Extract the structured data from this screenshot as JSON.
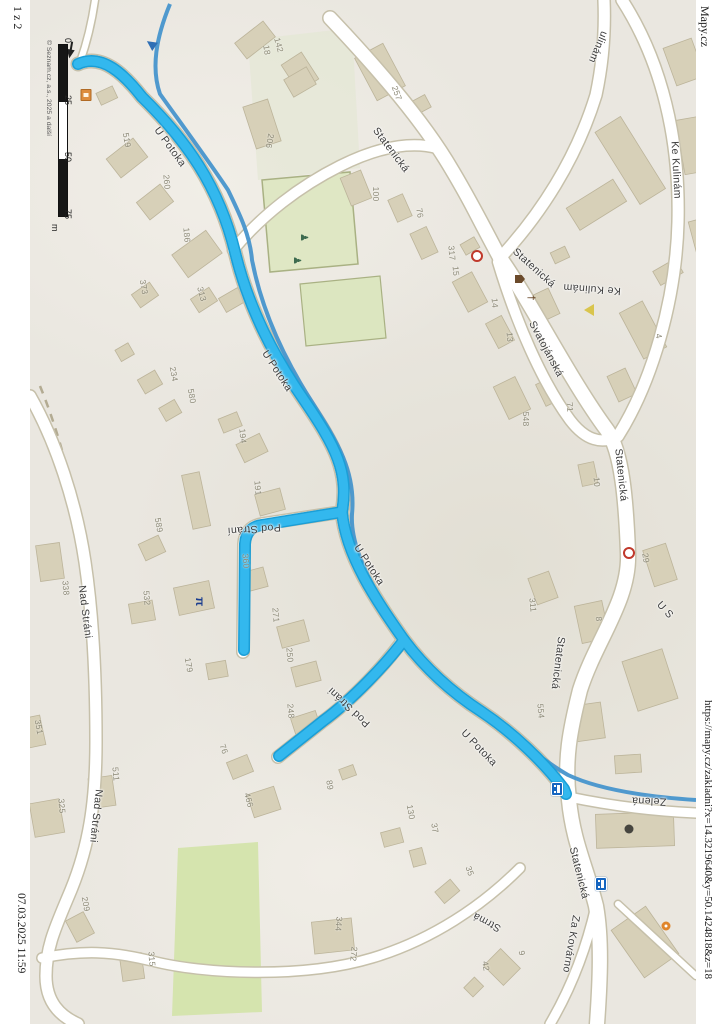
{
  "page": {
    "page_number": "1 z 2",
    "site": "Mapy.cz",
    "url": "https://mapy.cz/zakladni?x=14.3219640&y=50.1424818&z=18",
    "printed": "07.03.2025 11:59"
  },
  "map": {
    "attribution": "© Seznam.cz, a.s., 2025 a další",
    "scale_bar": {
      "ticks": [
        "0",
        "25",
        "50",
        "75"
      ],
      "unit": "m"
    },
    "route_color": "#28b2ea",
    "stream_color": "#4795cc",
    "street_labels": [
      {
        "text": "U Potoka",
        "x": 170,
        "y": 147,
        "rot": 54
      },
      {
        "text": "U Potoka",
        "x": 277,
        "y": 371,
        "rot": 57
      },
      {
        "text": "U Potoka",
        "x": 369,
        "y": 565,
        "rot": 57
      },
      {
        "text": "U Potoka",
        "x": 479,
        "y": 748,
        "rot": 46
      },
      {
        "text": "Pod Strání",
        "x": 254,
        "y": 529,
        "rot": 176
      },
      {
        "text": "Pod Stráni",
        "x": 349,
        "y": 707,
        "rot": 223
      },
      {
        "text": "Statenická",
        "x": 391,
        "y": 150,
        "rot": 53
      },
      {
        "text": "Statenická",
        "x": 534,
        "y": 268,
        "rot": 42
      },
      {
        "text": "Statenická",
        "x": 621,
        "y": 475,
        "rot": 84
      },
      {
        "text": "Statenická",
        "x": 558,
        "y": 663,
        "rot": 97
      },
      {
        "text": "Statenická",
        "x": 579,
        "y": 873,
        "rot": 76
      },
      {
        "text": "Svatojánská",
        "x": 546,
        "y": 349,
        "rot": 62
      },
      {
        "text": "Ke Kulinám",
        "x": 592,
        "y": 289,
        "rot": 184
      },
      {
        "text": "Ke Kulinám",
        "x": 676,
        "y": 170,
        "rot": 87
      },
      {
        "text": "ulinám",
        "x": 598,
        "y": 47,
        "rot": 113
      },
      {
        "text": "Nad Stráni",
        "x": 85,
        "y": 612,
        "rot": 83
      },
      {
        "text": "Nad Stráni",
        "x": 96,
        "y": 816,
        "rot": 96
      },
      {
        "text": "Zelená",
        "x": 649,
        "y": 801,
        "rot": 182
      },
      {
        "text": "Strmá",
        "x": 487,
        "y": 922,
        "rot": 208
      },
      {
        "text": "Za Kovárno",
        "x": 571,
        "y": 944,
        "rot": 100
      },
      {
        "text": "U S",
        "x": 665,
        "y": 610,
        "rot": 48
      }
    ],
    "house_numbers": [
      {
        "text": "142",
        "x": 279,
        "y": 45,
        "rot": 75
      },
      {
        "text": "18",
        "x": 267,
        "y": 50,
        "rot": 80
      },
      {
        "text": "206",
        "x": 270,
        "y": 141,
        "rot": 100
      },
      {
        "text": "519",
        "x": 127,
        "y": 140,
        "rot": 80
      },
      {
        "text": "260",
        "x": 167,
        "y": 182,
        "rot": 85
      },
      {
        "text": "186",
        "x": 187,
        "y": 235,
        "rot": 85
      },
      {
        "text": "257",
        "x": 397,
        "y": 93,
        "rot": 70
      },
      {
        "text": "100",
        "x": 376,
        "y": 194,
        "rot": 90
      },
      {
        "text": "76",
        "x": 420,
        "y": 213,
        "rot": 80
      },
      {
        "text": "317",
        "x": 452,
        "y": 253,
        "rot": 85
      },
      {
        "text": "15",
        "x": 456,
        "y": 271,
        "rot": 85
      },
      {
        "text": "14",
        "x": 495,
        "y": 303,
        "rot": 85
      },
      {
        "text": "13",
        "x": 510,
        "y": 337,
        "rot": 85
      },
      {
        "text": "548",
        "x": 526,
        "y": 419,
        "rot": 90
      },
      {
        "text": "71",
        "x": 570,
        "y": 407,
        "rot": 85
      },
      {
        "text": "10",
        "x": 597,
        "y": 482,
        "rot": 85
      },
      {
        "text": "4",
        "x": 659,
        "y": 336,
        "rot": 80
      },
      {
        "text": "29",
        "x": 646,
        "y": 558,
        "rot": 80
      },
      {
        "text": "8",
        "x": 599,
        "y": 619,
        "rot": 85
      },
      {
        "text": "311",
        "x": 533,
        "y": 605,
        "rot": 85
      },
      {
        "text": "554",
        "x": 541,
        "y": 711,
        "rot": 85
      },
      {
        "text": "130",
        "x": 411,
        "y": 812,
        "rot": 80
      },
      {
        "text": "37",
        "x": 435,
        "y": 828,
        "rot": 80
      },
      {
        "text": "35",
        "x": 470,
        "y": 871,
        "rot": 70
      },
      {
        "text": "373",
        "x": 144,
        "y": 287,
        "rot": 80
      },
      {
        "text": "313",
        "x": 202,
        "y": 294,
        "rot": 75
      },
      {
        "text": "234",
        "x": 174,
        "y": 374,
        "rot": 80
      },
      {
        "text": "580",
        "x": 192,
        "y": 396,
        "rot": 80
      },
      {
        "text": "194",
        "x": 243,
        "y": 436,
        "rot": 85
      },
      {
        "text": "191",
        "x": 258,
        "y": 488,
        "rot": 85
      },
      {
        "text": "589",
        "x": 159,
        "y": 525,
        "rot": 80
      },
      {
        "text": "532",
        "x": 147,
        "y": 598,
        "rot": 85
      },
      {
        "text": "179",
        "x": 189,
        "y": 665,
        "rot": 80
      },
      {
        "text": "338",
        "x": 66,
        "y": 588,
        "rot": 85
      },
      {
        "text": "360",
        "x": 246,
        "y": 561,
        "rot": 85
      },
      {
        "text": "271",
        "x": 276,
        "y": 615,
        "rot": 85
      },
      {
        "text": "250",
        "x": 290,
        "y": 655,
        "rot": 85
      },
      {
        "text": "248",
        "x": 291,
        "y": 711,
        "rot": 85
      },
      {
        "text": "76",
        "x": 224,
        "y": 749,
        "rot": 70
      },
      {
        "text": "466",
        "x": 249,
        "y": 800,
        "rot": 75
      },
      {
        "text": "89",
        "x": 330,
        "y": 785,
        "rot": 80
      },
      {
        "text": "351",
        "x": 39,
        "y": 727,
        "rot": 80
      },
      {
        "text": "511",
        "x": 116,
        "y": 774,
        "rot": 85
      },
      {
        "text": "325",
        "x": 62,
        "y": 806,
        "rot": 85
      },
      {
        "text": "209",
        "x": 86,
        "y": 904,
        "rot": 80
      },
      {
        "text": "315",
        "x": 152,
        "y": 959,
        "rot": 85
      },
      {
        "text": "344",
        "x": 339,
        "y": 924,
        "rot": 95
      },
      {
        "text": "272",
        "x": 354,
        "y": 954,
        "rot": 95
      },
      {
        "text": "9",
        "x": 522,
        "y": 953,
        "rot": 80
      },
      {
        "text": "42",
        "x": 486,
        "y": 966,
        "rot": 80
      }
    ],
    "icons": [
      {
        "name": "north-arrow-icon",
        "x": 70,
        "y": 54,
        "rot": 10
      },
      {
        "name": "bus-shelter-icon",
        "x": 86,
        "y": 95,
        "rot": 90
      },
      {
        "name": "oneway-arrow-icon",
        "x": 151,
        "y": 44,
        "rot": 35
      },
      {
        "name": "playground-icon",
        "x": 303,
        "y": 233,
        "rot": 90
      },
      {
        "name": "playground-icon",
        "x": 296,
        "y": 256,
        "rot": 90
      },
      {
        "name": "church-icon",
        "x": 520,
        "y": 279,
        "rot": 90
      },
      {
        "name": "memorial-icon",
        "x": 530,
        "y": 295,
        "rot": 90
      },
      {
        "name": "give-way-icon",
        "x": 589,
        "y": 310,
        "rot": 90
      },
      {
        "name": "poi-circle-icon",
        "x": 477,
        "y": 256,
        "rot": 0
      },
      {
        "name": "poi-circle-icon",
        "x": 629,
        "y": 553,
        "rot": 0
      },
      {
        "name": "picnic-icon",
        "x": 200,
        "y": 597,
        "rot": 90
      },
      {
        "name": "bus-stop-icon",
        "x": 557,
        "y": 789,
        "rot": 90
      },
      {
        "name": "bus-stop-icon",
        "x": 601,
        "y": 884,
        "rot": 90
      },
      {
        "name": "poi-dark-icon",
        "x": 629,
        "y": 829,
        "rot": 0
      },
      {
        "name": "restaurant-icon",
        "x": 666,
        "y": 926,
        "rot": 90
      }
    ]
  }
}
